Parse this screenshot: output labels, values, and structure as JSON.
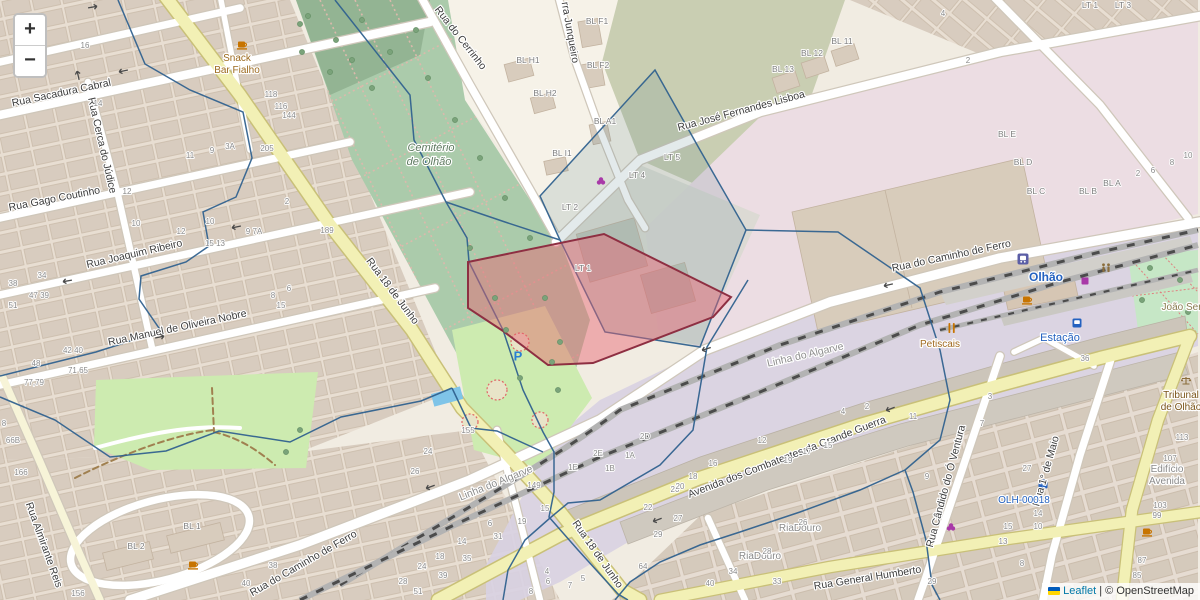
{
  "map": {
    "controls": {
      "zoom_in_label": "+",
      "zoom_out_label": "−"
    },
    "attribution": {
      "leaflet_link": "Leaflet",
      "separator": "|",
      "copyright": "© OpenStreetMap"
    },
    "colors": {
      "selection_red_fill": "rgba(232,98,110,0.45)",
      "selection_red_stroke": "#8e2f42",
      "parcel_blue": "#31628f",
      "road_yellow": "#f2f0b5",
      "rail_gray": "#4c4c4c",
      "transport_label_blue": "#2462c0",
      "poi_brown": "#7a5418",
      "leaflet_link_blue": "#0078a8"
    },
    "labels": {
      "streets": [
        {
          "t": "Rua Sacadura Cabral",
          "x": 62,
          "y": 96,
          "r": -12
        },
        {
          "t": "Rua Cerca do Júdice",
          "x": 99,
          "y": 146,
          "r": 77
        },
        {
          "t": "Rua Gago Coutinho",
          "x": 55,
          "y": 202,
          "r": -11
        },
        {
          "t": "Rua Joaquim Ribeiro",
          "x": 135,
          "y": 257,
          "r": -13
        },
        {
          "t": "Rua Manuel de Oliveira Nobre",
          "x": 178,
          "y": 331,
          "r": -12
        },
        {
          "t": "Rua Almirante Reis",
          "x": 41,
          "y": 546,
          "r": 70
        },
        {
          "t": "Rua do Caminho de Ferro",
          "x": 305,
          "y": 566,
          "r": -30
        },
        {
          "t": "Rua do Cerrinho",
          "x": 458,
          "y": 40,
          "r": 52
        },
        {
          "t": "rra Junqueiro",
          "x": 567,
          "y": 33,
          "r": 80
        },
        {
          "t": "Rua José Fernandes Lisboa",
          "x": 742,
          "y": 114,
          "r": -15
        },
        {
          "t": "Rua do Caminho de Ferro",
          "x": 952,
          "y": 259,
          "r": -12
        },
        {
          "t": "Rua 18 de Junho",
          "x": 390,
          "y": 293,
          "r": 53
        },
        {
          "t": "Rua 18 de Junho",
          "x": 595,
          "y": 556,
          "r": 55
        },
        {
          "t": "Avenida dos Combatentes da Grande Guerra",
          "x": 788,
          "y": 460,
          "r": -21
        },
        {
          "t": "Rua General Humberto",
          "x": 868,
          "y": 581,
          "r": -9
        },
        {
          "t": "Rua 1° de Maio",
          "x": 1049,
          "y": 472,
          "r": -74
        },
        {
          "t": "Rua Cândido do Ó Ventura",
          "x": 949,
          "y": 487,
          "r": -75
        },
        {
          "t": "Linha do Algarve",
          "x": 806,
          "y": 358,
          "r": -13,
          "c": "#8d8d8d"
        },
        {
          "t": "Linha do Algarve",
          "x": 497,
          "y": 486,
          "r": -22,
          "c": "#8d8d8d"
        }
      ],
      "pois": [
        {
          "t": "Snack",
          "x": 237,
          "y": 61,
          "c": "#9c6a1e"
        },
        {
          "t": "Bar Fialho",
          "x": 237,
          "y": 73,
          "c": "#9c6a1e"
        },
        {
          "t": "Cemitério",
          "x": 431,
          "y": 151,
          "c": "#5e7a60",
          "i": 1,
          "s": 11
        },
        {
          "t": "de Olhão",
          "x": 429,
          "y": 165,
          "c": "#5e7a60",
          "i": 1,
          "s": 11
        },
        {
          "t": "Olhão",
          "x": 1046,
          "y": 281,
          "c": "#2462c0",
          "s": 12,
          "b": 1
        },
        {
          "t": "Estação",
          "x": 1060,
          "y": 341,
          "c": "#2462c0",
          "s": 11
        },
        {
          "t": "OLH-00018",
          "x": 1024,
          "y": 503,
          "c": "#2462c0",
          "s": 10
        },
        {
          "t": "Petiscais",
          "x": 940,
          "y": 347,
          "c": "#a06a20"
        },
        {
          "t": "João Serra",
          "x": 1186,
          "y": 310,
          "c": "#887b4e"
        },
        {
          "t": "Tribunal",
          "x": 1181,
          "y": 398,
          "c": "#7a5418"
        },
        {
          "t": "de Olhão",
          "x": 1181,
          "y": 410,
          "c": "#7a5418"
        },
        {
          "t": "RiaDouro",
          "x": 800,
          "y": 531,
          "c": "#8a8a8a"
        },
        {
          "t": "RiaDouro",
          "x": 760,
          "y": 559,
          "c": "#8a8a8a"
        },
        {
          "t": "Edifício",
          "x": 1167,
          "y": 472,
          "c": "#8a8a8a"
        },
        {
          "t": "Avenida",
          "x": 1167,
          "y": 484,
          "c": "#8a8a8a"
        }
      ],
      "blocks": [
        [
          528,
          63,
          "BL H1"
        ],
        [
          545,
          96,
          "BL H2"
        ],
        [
          597,
          24,
          "BL F1"
        ],
        [
          598,
          68,
          "BL F2"
        ],
        [
          605,
          124,
          "BL A1"
        ],
        [
          562,
          156,
          "BL I1"
        ],
        [
          842,
          44,
          "BL 11"
        ],
        [
          812,
          56,
          "BL 12"
        ],
        [
          783,
          72,
          "BL 13"
        ],
        [
          672,
          160,
          "LT 5"
        ],
        [
          637,
          178,
          "LT 4"
        ],
        [
          570,
          210,
          "LT 2"
        ],
        [
          583,
          271,
          "LT 1"
        ],
        [
          1090,
          8,
          "LT 1"
        ],
        [
          1123,
          8,
          "LT 3"
        ],
        [
          1007,
          137,
          "BL E"
        ],
        [
          1023,
          165,
          "BL D"
        ],
        [
          1036,
          194,
          "BL C"
        ],
        [
          1088,
          194,
          "BL B"
        ],
        [
          1112,
          186,
          "BL A"
        ],
        [
          192,
          529,
          "BL 1"
        ],
        [
          136,
          549,
          "BL 2"
        ]
      ],
      "numbers": [
        [
          85,
          48,
          "16"
        ],
        [
          98,
          106,
          "14"
        ],
        [
          271,
          97,
          "118"
        ],
        [
          281,
          109,
          "116"
        ],
        [
          289,
          118,
          "144"
        ],
        [
          267,
          151,
          "205"
        ],
        [
          190,
          158,
          "11"
        ],
        [
          212,
          153,
          "9"
        ],
        [
          230,
          149,
          "3A"
        ],
        [
          127,
          194,
          "12"
        ],
        [
          136,
          226,
          "10"
        ],
        [
          181,
          234,
          "12"
        ],
        [
          210,
          224,
          "10"
        ],
        [
          215,
          246,
          "15 13"
        ],
        [
          254,
          234,
          "9 7A"
        ],
        [
          287,
          204,
          "2"
        ],
        [
          327,
          233,
          "189"
        ],
        [
          42,
          278,
          "34"
        ],
        [
          13,
          286,
          "38"
        ],
        [
          39,
          298,
          "47 39"
        ],
        [
          13,
          308,
          "51"
        ],
        [
          73,
          353,
          "42 40"
        ],
        [
          36,
          366,
          "48"
        ],
        [
          78,
          373,
          "71 65"
        ],
        [
          34,
          385,
          "77,79"
        ],
        [
          273,
          298,
          "8"
        ],
        [
          289,
          291,
          "6"
        ],
        [
          281,
          308,
          "15"
        ],
        [
          4,
          426,
          "8"
        ],
        [
          13,
          443,
          "66B"
        ],
        [
          21,
          475,
          "166"
        ],
        [
          78,
          596,
          "156"
        ],
        [
          273,
          568,
          "38"
        ],
        [
          246,
          586,
          "40"
        ],
        [
          468,
          433,
          "155"
        ],
        [
          428,
          454,
          "24"
        ],
        [
          415,
          474,
          "26"
        ],
        [
          534,
          488,
          "149"
        ],
        [
          545,
          511,
          "15"
        ],
        [
          522,
          524,
          "19"
        ],
        [
          490,
          526,
          "6"
        ],
        [
          462,
          544,
          "14"
        ],
        [
          498,
          539,
          "31"
        ],
        [
          440,
          559,
          "18"
        ],
        [
          467,
          561,
          "35"
        ],
        [
          422,
          569,
          "24"
        ],
        [
          443,
          578,
          "39"
        ],
        [
          403,
          584,
          "28"
        ],
        [
          418,
          594,
          "51"
        ],
        [
          598,
          456,
          "2E"
        ],
        [
          573,
          470,
          "1E"
        ],
        [
          610,
          471,
          "1B"
        ],
        [
          630,
          458,
          "1A"
        ],
        [
          645,
          439,
          "2D"
        ],
        [
          648,
          510,
          "22"
        ],
        [
          658,
          537,
          "29"
        ],
        [
          643,
          569,
          "64"
        ],
        [
          675,
          492,
          "20"
        ],
        [
          547,
          574,
          "4"
        ],
        [
          548,
          584,
          "6"
        ],
        [
          531,
          594,
          "8"
        ],
        [
          583,
          581,
          "5"
        ],
        [
          570,
          588,
          "7"
        ],
        [
          713,
          466,
          "16"
        ],
        [
          693,
          479,
          "18"
        ],
        [
          680,
          489,
          "20"
        ],
        [
          678,
          521,
          "27"
        ],
        [
          762,
          443,
          "12"
        ],
        [
          788,
          463,
          "19"
        ],
        [
          807,
          454,
          "17"
        ],
        [
          828,
          448,
          "15"
        ],
        [
          843,
          414,
          "4"
        ],
        [
          867,
          409,
          "2"
        ],
        [
          913,
          419,
          "11"
        ],
        [
          803,
          525,
          "26"
        ],
        [
          767,
          554,
          "28"
        ],
        [
          733,
          574,
          "34"
        ],
        [
          777,
          584,
          "33"
        ],
        [
          710,
          586,
          "40"
        ],
        [
          927,
          479,
          "9"
        ],
        [
          932,
          584,
          "29"
        ],
        [
          990,
          399,
          "3"
        ],
        [
          982,
          426,
          "7"
        ],
        [
          1027,
          471,
          "27"
        ],
        [
          1038,
          516,
          "14"
        ],
        [
          1008,
          529,
          "15"
        ],
        [
          1038,
          529,
          "10"
        ],
        [
          1003,
          544,
          "13"
        ],
        [
          1022,
          566,
          "8"
        ],
        [
          1182,
          440,
          "113"
        ],
        [
          1170,
          461,
          "107"
        ],
        [
          1160,
          508,
          "103"
        ],
        [
          1157,
          518,
          "99"
        ],
        [
          1142,
          563,
          "87"
        ],
        [
          1137,
          578,
          "85"
        ],
        [
          1085,
          361,
          "36"
        ],
        [
          968,
          63,
          "2"
        ],
        [
          943,
          16,
          "4"
        ],
        [
          1138,
          176,
          "2"
        ],
        [
          1153,
          173,
          "6"
        ],
        [
          1172,
          165,
          "8"
        ],
        [
          1188,
          158,
          "10"
        ]
      ],
      "arrows": [
        [
          93,
          7,
          -10
        ],
        [
          123,
          71,
          168
        ],
        [
          78,
          75,
          -103
        ],
        [
          67,
          281,
          170
        ],
        [
          236,
          227,
          168
        ],
        [
          160,
          337,
          -12
        ],
        [
          430,
          487,
          160
        ],
        [
          888,
          285,
          167
        ],
        [
          706,
          349,
          162
        ],
        [
          890,
          409,
          159
        ],
        [
          657,
          520,
          159
        ]
      ]
    },
    "icons": [
      {
        "n": "train-station-icon",
        "x": 1023,
        "y": 259
      },
      {
        "n": "bus-stop-icon",
        "x": 1077,
        "y": 323
      },
      {
        "n": "charging-station-icon",
        "x": 1043,
        "y": 484
      },
      {
        "n": "parking-icon",
        "x": 518,
        "y": 356
      },
      {
        "n": "cafe-icon",
        "x": 242,
        "y": 45
      },
      {
        "n": "cafe-icon",
        "x": 193,
        "y": 565
      },
      {
        "n": "cafe-icon",
        "x": 1027,
        "y": 300
      },
      {
        "n": "cafe-icon",
        "x": 1147,
        "y": 532
      },
      {
        "n": "restaurant-icon",
        "x": 952,
        "y": 328
      },
      {
        "n": "toilets-icon",
        "x": 1106,
        "y": 268
      },
      {
        "n": "convenience-icon",
        "x": 1085,
        "y": 281
      },
      {
        "n": "greengrocer-icon",
        "x": 601,
        "y": 181
      },
      {
        "n": "wine-shop-icon",
        "x": 951,
        "y": 527
      },
      {
        "n": "justice-icon",
        "x": 1186,
        "y": 381
      },
      {
        "n": "tree-icon",
        "x": 308,
        "y": 16
      },
      {
        "n": "tree-icon",
        "x": 336,
        "y": 40
      },
      {
        "n": "tree-icon",
        "x": 362,
        "y": 20
      },
      {
        "n": "tree-icon",
        "x": 390,
        "y": 52
      },
      {
        "n": "tree-icon",
        "x": 416,
        "y": 30
      },
      {
        "n": "tree-icon",
        "x": 330,
        "y": 72
      },
      {
        "n": "tree-icon",
        "x": 302,
        "y": 52
      },
      {
        "n": "tree-icon",
        "x": 428,
        "y": 78
      },
      {
        "n": "tree-icon",
        "x": 372,
        "y": 88
      },
      {
        "n": "tree-icon",
        "x": 300,
        "y": 24
      },
      {
        "n": "tree-icon",
        "x": 352,
        "y": 60
      },
      {
        "n": "tree-icon",
        "x": 455,
        "y": 120
      },
      {
        "n": "tree-icon",
        "x": 480,
        "y": 158
      },
      {
        "n": "tree-icon",
        "x": 505,
        "y": 198
      },
      {
        "n": "tree-icon",
        "x": 530,
        "y": 238
      },
      {
        "n": "tree-icon",
        "x": 470,
        "y": 248
      },
      {
        "n": "tree-icon",
        "x": 495,
        "y": 298
      },
      {
        "n": "tree-icon",
        "x": 545,
        "y": 298
      },
      {
        "n": "tree-icon",
        "x": 560,
        "y": 342
      },
      {
        "n": "tree-icon",
        "x": 520,
        "y": 378
      },
      {
        "n": "tree-icon",
        "x": 558,
        "y": 390
      },
      {
        "n": "tree-icon",
        "x": 506,
        "y": 330
      },
      {
        "n": "tree-icon",
        "x": 552,
        "y": 362
      },
      {
        "n": "tree-icon",
        "x": 1150,
        "y": 268
      },
      {
        "n": "tree-icon",
        "x": 1180,
        "y": 280
      },
      {
        "n": "tree-icon",
        "x": 1142,
        "y": 300
      },
      {
        "n": "tree-icon",
        "x": 1188,
        "y": 312
      },
      {
        "n": "tree-icon",
        "x": 286,
        "y": 452
      },
      {
        "n": "tree-icon",
        "x": 300,
        "y": 430
      }
    ]
  }
}
